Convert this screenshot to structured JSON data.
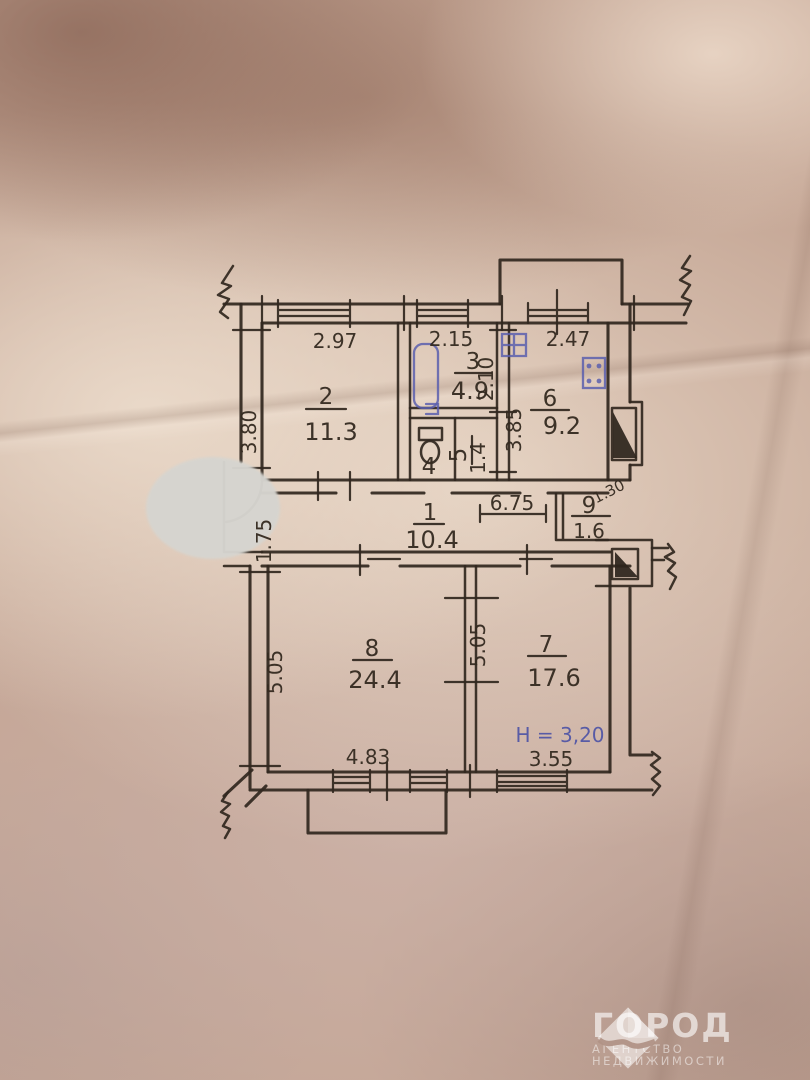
{
  "plan": {
    "rooms": {
      "r1": {
        "number": "1",
        "area": "10.4"
      },
      "r2": {
        "number": "2",
        "area": "11.3"
      },
      "r3": {
        "number": "3",
        "area": "4.9"
      },
      "r4": {
        "number": "4"
      },
      "r5": {
        "number": "5",
        "area": "1.4"
      },
      "r6": {
        "number": "6",
        "area": "9.2"
      },
      "r7": {
        "number": "7",
        "area": "17.6"
      },
      "r8": {
        "number": "8",
        "area": "24.4"
      },
      "r9": {
        "number": "9",
        "area": "1.6"
      }
    },
    "dims": {
      "w2": "2.97",
      "d2": "3.80",
      "w3": "2.15",
      "d3": "2.10",
      "w6": "2.47",
      "d6": "3.85",
      "corridor": "6.75",
      "hall_left": "1.75",
      "r9_diag": "1.30",
      "d8": "5.05",
      "d78": "5.05",
      "w8": "4.83",
      "w7": "3.55",
      "height_note": "Н = 3,20"
    }
  },
  "watermark": {
    "brand": "ГОРОД",
    "line1": "АГЕНТСТВО",
    "line2": "НЕДВИЖИМОСТИ"
  },
  "colors": {
    "ink": "#32281f",
    "blue_ink": "#5a5fae",
    "paper": "#c3a493",
    "censor": "#d6d5d0",
    "watermark": "#ffffff"
  }
}
